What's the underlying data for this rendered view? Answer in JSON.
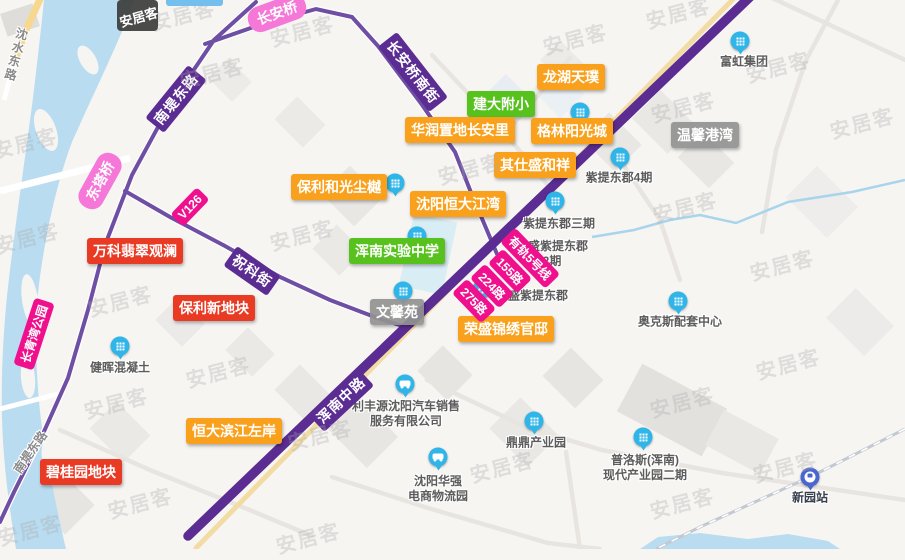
{
  "app": {
    "name": "anjuke-map",
    "watermark": "安居客",
    "logo_badge": "安居客"
  },
  "colors": {
    "water": "#b9dcf1",
    "trunk_road": "#5b2c91",
    "secondary_road": "#6f4fa4",
    "tram_line": "#f2dca4",
    "badge_orange": "#f9a11c",
    "badge_green": "#57c11e",
    "badge_red": "#e93a24",
    "badge_gray": "#919191",
    "route_pill": "#f0108d",
    "bridge_pill": "#f578d8",
    "marker_blue": "#2fb5e8",
    "station_blue": "#4a67d0"
  },
  "place_labels": [
    {
      "id": "longhu",
      "text": "龙湖天璞",
      "type": "orange"
    },
    {
      "id": "jianda",
      "text": "建大附小",
      "type": "green"
    },
    {
      "id": "huarun",
      "text": "华润置地长安里",
      "type": "orange"
    },
    {
      "id": "gelin",
      "text": "格林阳光城",
      "type": "orange"
    },
    {
      "id": "wenxingangwan",
      "text": "温馨港湾",
      "type": "gray"
    },
    {
      "id": "qishi",
      "text": "其仕盛和祥",
      "type": "orange"
    },
    {
      "id": "baoliheguang",
      "text": "保利和光尘樾",
      "type": "orange"
    },
    {
      "id": "hengdajiangwan",
      "text": "沈阳恒大江湾",
      "type": "orange"
    },
    {
      "id": "hunnanschool",
      "text": "浑南实验中学",
      "type": "green"
    },
    {
      "id": "wanke",
      "text": "万科翡翠观澜",
      "type": "red"
    },
    {
      "id": "baolixin",
      "text": "保利新地块",
      "type": "red"
    },
    {
      "id": "wenxinyuan",
      "text": "文馨苑",
      "type": "gray"
    },
    {
      "id": "rongshengjinxiu",
      "text": "荣盛锦绣官邸",
      "type": "orange"
    },
    {
      "id": "hengdabinjiang",
      "text": "恒大滨江左岸",
      "type": "orange"
    },
    {
      "id": "biguiyuan",
      "text": "碧桂园地块",
      "type": "red"
    }
  ],
  "road_labels": [
    {
      "id": "nandi",
      "text": "南堤东路"
    },
    {
      "id": "changanqiaonanjie",
      "text": "长安桥南街"
    },
    {
      "id": "zhuke",
      "text": "祝科街"
    },
    {
      "id": "hunnanzhonglu",
      "text": "浑南中路"
    }
  ],
  "gray_road_labels": [
    {
      "id": "shenshui",
      "text": "沈水东路"
    },
    {
      "id": "nandinan",
      "text": "南堤东路"
    }
  ],
  "pills": [
    {
      "id": "changanqiao",
      "text": "长安桥",
      "type": "pink"
    },
    {
      "id": "dongtaqiao",
      "text": "东塔桥",
      "type": "pink"
    },
    {
      "id": "changqingwan",
      "text": "长青湾公园",
      "type": "magenta"
    },
    {
      "id": "v126",
      "text": "V126",
      "type": "magenta"
    },
    {
      "id": "tram5",
      "text": "有轨5号线",
      "type": "magenta"
    },
    {
      "id": "b155",
      "text": "155路",
      "type": "magenta"
    },
    {
      "id": "b224",
      "text": "224路",
      "type": "magenta"
    },
    {
      "id": "b275",
      "text": "275路",
      "type": "magenta"
    }
  ],
  "pois": [
    {
      "id": "fuhong",
      "lines": [
        "富虹集团"
      ],
      "icon": "building-icon"
    },
    {
      "id": "zidong4",
      "lines": [
        "紫提东郡4期"
      ],
      "icon": "building-icon"
    },
    {
      "id": "zidong3",
      "lines": [
        "紫提东郡三期"
      ],
      "icon": "building-icon"
    },
    {
      "id": "rszidong2",
      "lines": [
        "荣盛紫提东郡",
        "2期"
      ],
      "icon": ""
    },
    {
      "id": "rszidong",
      "lines": [
        "荣盛紫提东郡"
      ],
      "icon": "building-icon"
    },
    {
      "id": "aokesi",
      "lines": [
        "奥克斯配套中心"
      ],
      "icon": "building-icon"
    },
    {
      "id": "jianhui",
      "lines": [
        "健晖混凝土"
      ],
      "icon": "building-icon"
    },
    {
      "id": "lifengyuan",
      "lines": [
        "利丰源沈阳汽车销售",
        "服务有限公司"
      ],
      "icon": "car-icon"
    },
    {
      "id": "dingding",
      "lines": [
        "鼎鼎产业园"
      ],
      "icon": "building-icon"
    },
    {
      "id": "huaqiang",
      "lines": [
        "沈阳华强",
        "电商物流园"
      ],
      "icon": "car-icon"
    },
    {
      "id": "puluosi",
      "lines": [
        "普洛斯(浑南)",
        "现代产业园二期"
      ],
      "icon": "building-icon"
    },
    {
      "id": "xinyuan",
      "lines": [
        "新园站"
      ],
      "icon": "train-icon",
      "dark": true
    }
  ],
  "extra_icons": [
    "building-icon",
    "building-icon",
    "building-icon",
    "building-icon"
  ]
}
